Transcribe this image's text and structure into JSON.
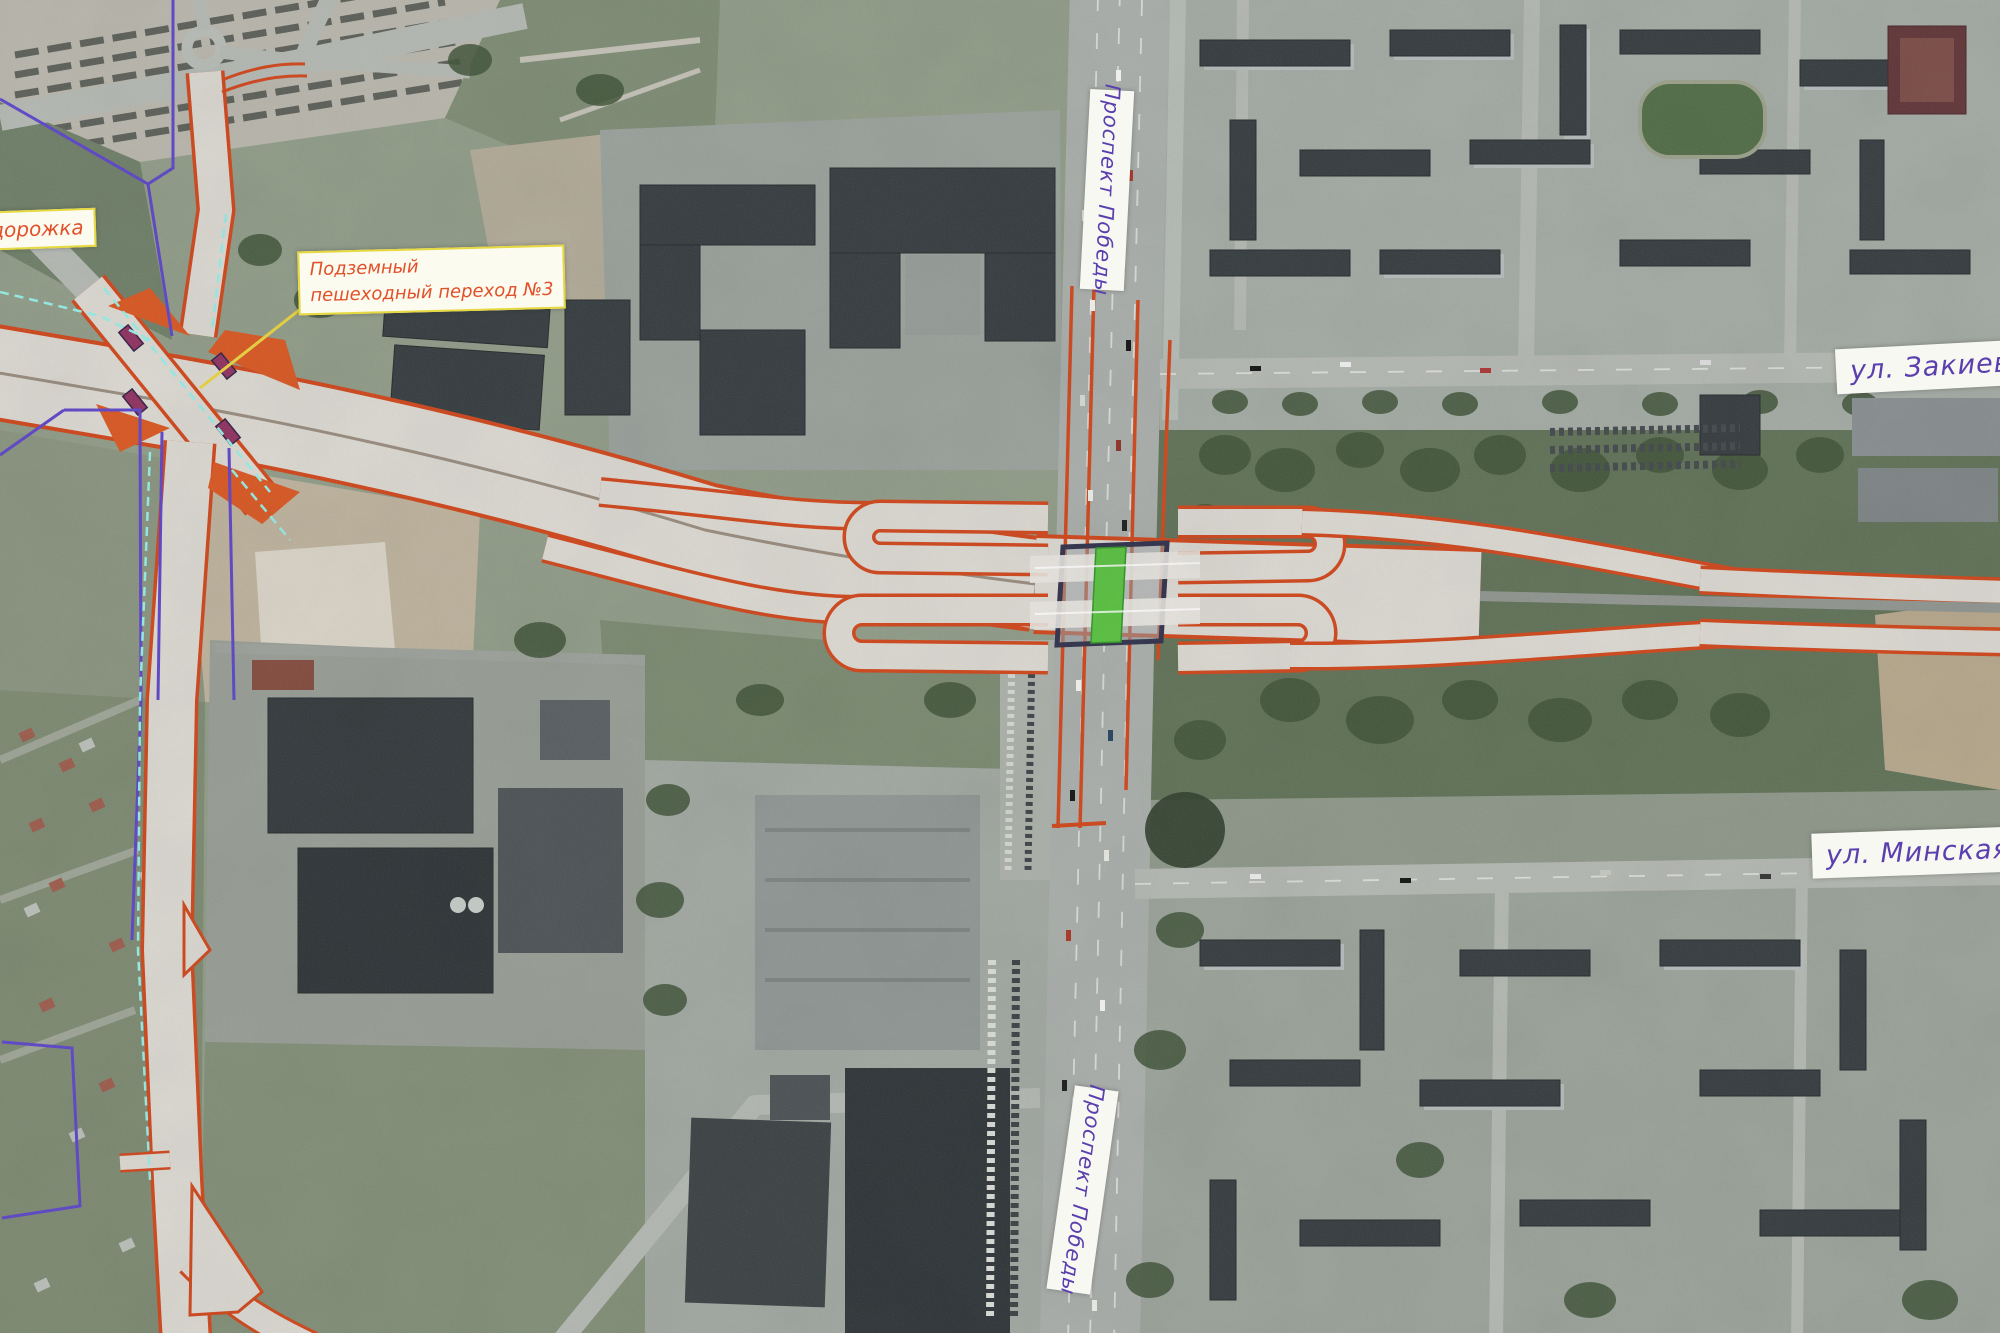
{
  "map": {
    "kind": "satellite-photo-with-road-design-overlay",
    "labels": {
      "bike_path_partial": "одорожка",
      "underpass_line1": "Подземный",
      "underpass_line2": "пешеходный переход №3",
      "prospekt_pobedy_top": "Проспект Победы",
      "prospekt_pobedy_bottom": "Проспект Победы",
      "street_zakieva": "ул. Закиева",
      "street_minskaya": "ул. Минская"
    },
    "colors": {
      "design_road": "#cf4418",
      "design_fill": "#dbd8d1",
      "median_green": "#57c13e",
      "tunnel_outline": "#2e2f4a",
      "street_label_text": "#5b3fae",
      "design_label_text": "#e2502a",
      "design_label_border": "#e6d83f",
      "boundary_purple": "#5b43c8",
      "path_cyan": "#93ece5",
      "leader_yellow": "#e8d23c"
    }
  }
}
